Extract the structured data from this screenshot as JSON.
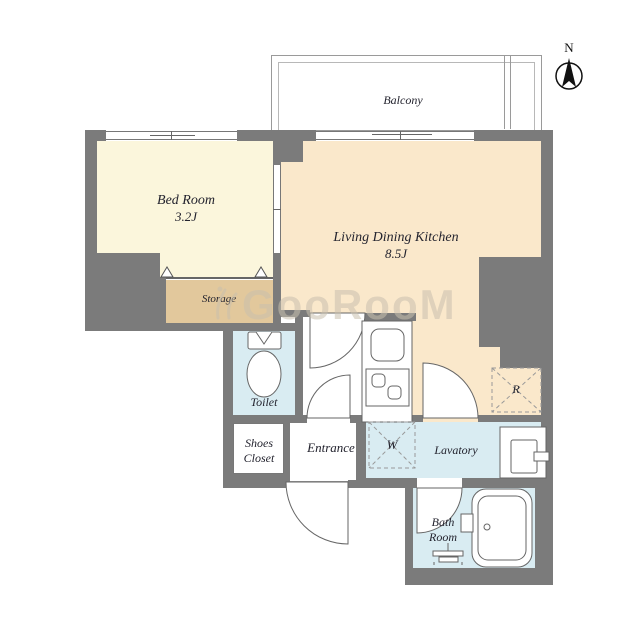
{
  "compass": {
    "north_label": "N"
  },
  "balcony": {
    "label": "Balcony"
  },
  "rooms": {
    "bedroom": {
      "name": "Bed Room",
      "size": "3.2J"
    },
    "living_dining_kitchen": {
      "name": "Living Dining Kitchen",
      "size": "8.5J"
    },
    "storage": {
      "name": "Storage"
    },
    "toilet": {
      "name": "Toilet"
    },
    "shoes_closet": {
      "name_line1": "Shoes",
      "name_line2": "Closet"
    },
    "entrance": {
      "name": "Entrance"
    },
    "lavatory": {
      "name": "Lavatory"
    },
    "bath_room": {
      "name_line1": "Bath",
      "name_line2": "Room"
    }
  },
  "appliance_marks": {
    "washer": "W",
    "refrigerator": "R"
  },
  "watermark": {
    "text": "GooRooM"
  },
  "colors": {
    "wall": "#7b7b7b",
    "bedroom_floor": "#fbf6dc",
    "ldk_floor": "#fae8cb",
    "storage_floor": "#e2c89c",
    "wet_floor": "#d9ecf2",
    "watermark_color": "#c9c0ae"
  }
}
